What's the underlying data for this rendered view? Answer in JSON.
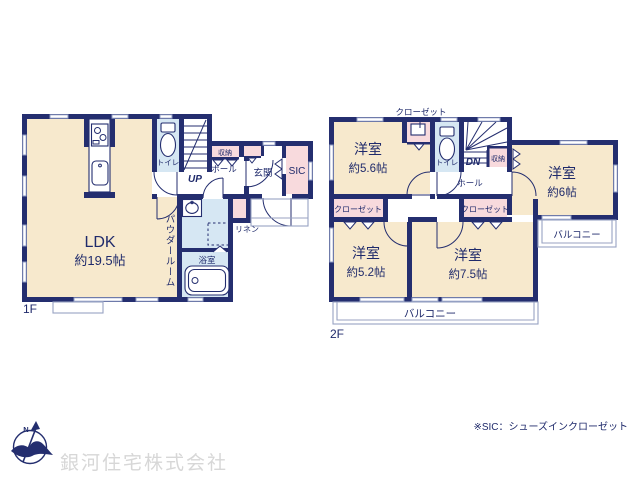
{
  "note": "※SIC：シューズインクローゼット",
  "company": "銀河住宅株式会社",
  "compass": {
    "north": "N"
  },
  "f1": {
    "floor_label": "1F",
    "ldk": "LDK",
    "ldk_size": "約19.5帖",
    "toilet": "トイレ",
    "up": "UP",
    "hall": "ホール",
    "storage": "収納",
    "entrance": "玄関",
    "sic": "SIC",
    "powder": "パウダールーム",
    "linen": "リネン",
    "bath": "浴室"
  },
  "f2": {
    "floor_label": "2F",
    "closet_top": "クローゼット",
    "closet_left": "クローゼット",
    "closet_center": "クローゼット",
    "room_nw": "洋室",
    "room_nw_size": "約5.6帖",
    "toilet": "トイレ",
    "dn": "DN",
    "storage": "収納",
    "hall": "ホール",
    "room_e": "洋室",
    "room_e_size": "約6帖",
    "room_sw": "洋室",
    "room_sw_size": "約5.2帖",
    "room_s": "洋室",
    "room_s_size": "約7.5帖",
    "balcony_s": "バルコニー",
    "balcony_e": "バルコニー"
  },
  "colors": {
    "wall": "#242e6f",
    "text": "#1f2a6b",
    "cream": "#f7e9cd",
    "pink": "#f8dadd",
    "blue": "#d6e7f3",
    "winline": "#8f9cc4",
    "thinline": "#98a2c2",
    "watermark": "#d7d7d7"
  }
}
